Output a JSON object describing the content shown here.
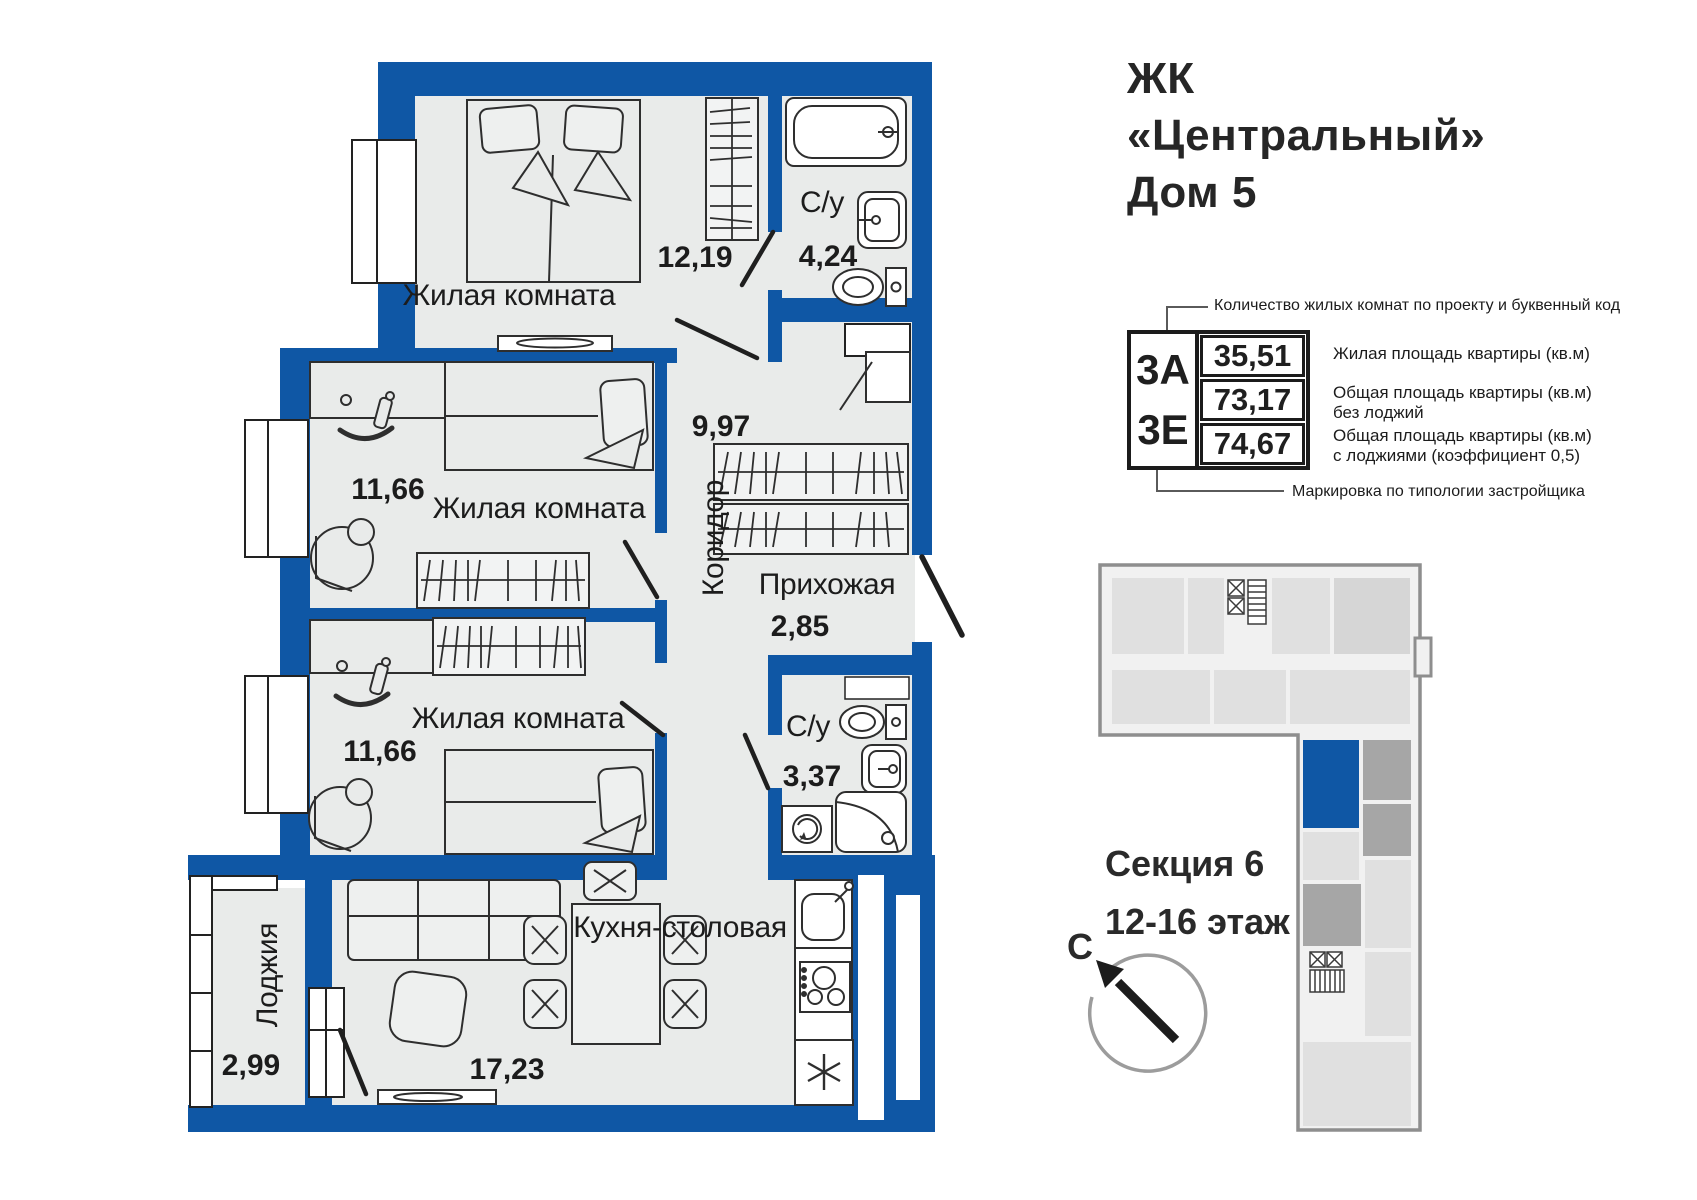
{
  "project": {
    "line1": "ЖК",
    "line2": "«Центральный»",
    "line3": "Дом 5"
  },
  "spec": {
    "codes": [
      "3А",
      "3Е"
    ],
    "values": [
      "35,51",
      "73,17",
      "74,67"
    ],
    "callout_top": "Количество жилых комнат по проекту и буквенный код",
    "callout_bottom": "Маркировка  по  типологии  застройщика",
    "annotations": [
      "Жилая площадь квартиры (кв.м)",
      "Общая площадь квартиры (кв.м)\nбез лоджий",
      "Общая площадь квартиры (кв.м)\nс лоджиями (коэффициент 0,5)"
    ]
  },
  "section": {
    "line1": "Секция 6",
    "line2": "12-16 этаж",
    "north_label": "С"
  },
  "rooms": [
    {
      "name": "Жилая комната",
      "area": "12,19"
    },
    {
      "name": "С/у",
      "area": "4,24"
    },
    {
      "name": "Жилая комната",
      "area": "11,66"
    },
    {
      "name": "Коридор",
      "area": "9,97"
    },
    {
      "name": "Прихожая",
      "area": "2,85"
    },
    {
      "name": "Жилая комната",
      "area": "11,66"
    },
    {
      "name": "С/у",
      "area": "3,37"
    },
    {
      "name": "Кухня-столовая",
      "area": "17,23"
    },
    {
      "name": "Лоджия",
      "area": "2,99"
    }
  ],
  "colors": {
    "wall": "#0f57a5",
    "floor": "#e9ebea",
    "highlight": "#0f57a5",
    "minimap_dark": "#a6a6a6"
  }
}
